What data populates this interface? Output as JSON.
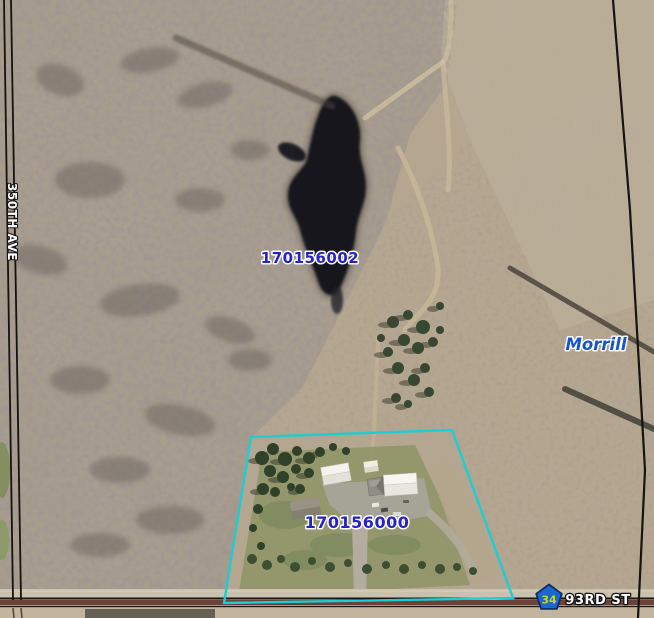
{
  "map": {
    "labels": {
      "parcel_north": "170156002",
      "parcel_south": "170156000",
      "place": "Morrill",
      "road_ns": "350TH AVE",
      "road_ew": "93RD ST",
      "highway_number": "34"
    },
    "colors": {
      "parcel_outline": "#1ecdd4",
      "parcel_id_text": "#2823c8",
      "place_text": "#1952cd",
      "road_text": "#ffffff",
      "badge_fill": "#1a67cf",
      "badge_text": "#c9d41c"
    }
  }
}
